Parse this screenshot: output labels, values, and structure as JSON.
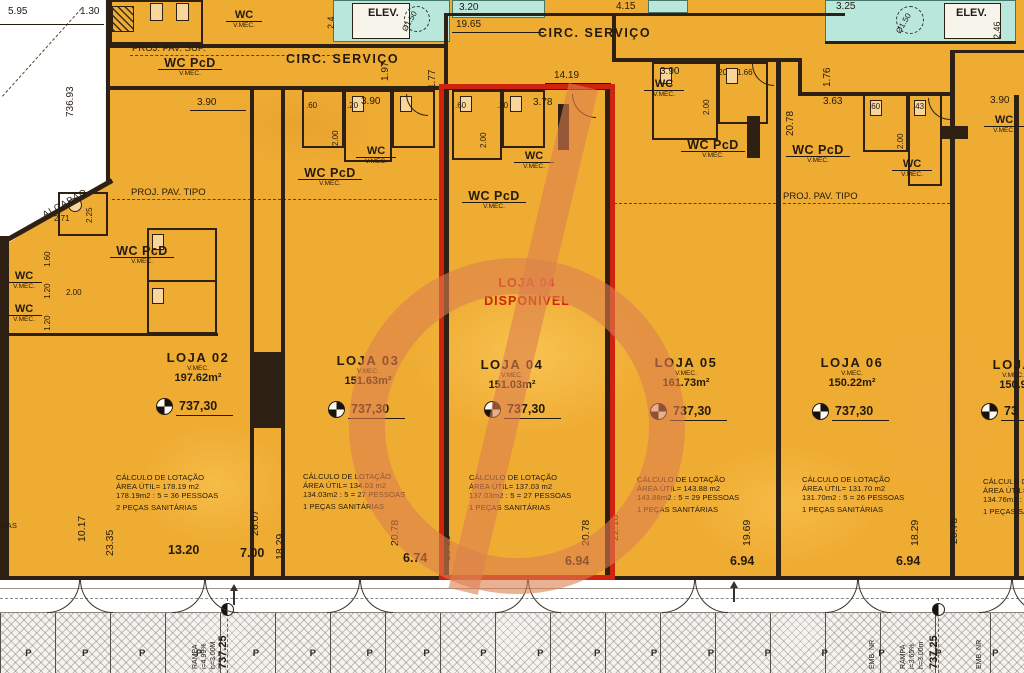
{
  "labels": {
    "circ_servico": "CIRC. SERVIÇO",
    "proj_pav_sup": "PROJ. PAV. SUP.",
    "proj_pav_tipo": "PROJ. PAV. TIPO",
    "elev": "ELEV.",
    "alcapao": "ALÇAPÃO",
    "wc": "WC",
    "wc_pcd": "WC PcD",
    "vmec": "V.MEC."
  },
  "highlight": {
    "unit": "LOJA 04",
    "status": "DISPONÍVEL",
    "border_color": "#cf2310"
  },
  "stores": [
    {
      "name": "LOJA 02",
      "area": "197.62m²",
      "calc": [
        "CÁLCULO DE LOTAÇÃO",
        "ÁREA ÚTIL= 178.19 m2",
        "178.19m2 : 5 = 36 PESSOAS",
        "2 PEÇAS SANITÁRIAS"
      ]
    },
    {
      "name": "LOJA 03",
      "area": "151.63m²",
      "calc": [
        "CÁLCULO DE LOTAÇÃO",
        "ÁREA ÚTIL= 134.03 m2",
        "134.03m2 : 5 = 27 PESSOAS",
        "1 PEÇAS SANITÁRIAS"
      ]
    },
    {
      "name": "LOJA 04",
      "area": "151.03m²",
      "calc": [
        "CÁLCULO DE LOTAÇÃO",
        "ÁREA ÚTIL= 137.03 m2",
        "137.03m2 : 5 = 27 PESSOAS",
        "1 PEÇAS SANITÁRIAS"
      ]
    },
    {
      "name": "LOJA 05",
      "area": "161.73m²",
      "calc": [
        "CÁLCULO DE LOTAÇÃO",
        "ÁREA ÚTIL= 143.88 m2",
        "143.88m2 : 5 = 29 PESSOAS",
        "1 PEÇAS SANITÁRIAS"
      ]
    },
    {
      "name": "LOJA 06",
      "area": "150.22m²",
      "calc": [
        "CÁLCULO DE LOTAÇÃO",
        "ÁREA ÚTIL= 131.70 m2",
        "131.70m2 : 5 = 26 PESSOAS",
        "1 PEÇAS SANITÁRIAS"
      ]
    },
    {
      "name": "LOJA",
      "area": "150.9",
      "level": "73",
      "calc": [
        "CÁLCULO DE LOTAÇÃO",
        "ÁREA ÚTIL= 134.76 m2",
        "134.76m2 : 5 =",
        "1 PEÇAS SANITÁRIAS"
      ]
    }
  ],
  "partial_left_calc": "PESSOAS",
  "levels": {
    "store": "737,30",
    "site": "737.25"
  },
  "dims": {
    "d595": "5.95",
    "d130": "1.30",
    "d73693": "736.93",
    "d225": "2.25",
    "d271": "2.71",
    "d160": "1.60",
    "d120": "1.20",
    "d200": "2.00",
    "d24": "2.4",
    "d320": "3.20",
    "d1965": "19.65",
    "d415": "4.15",
    "d197": "1.97",
    "d177": "1.77",
    "d1419": "14.19",
    "d325": "3.25",
    "d246": "2.46",
    "d176": "1.76",
    "d2078": "20.78",
    "d363": "3.63",
    "d390": "3.90",
    "d378": "3.78",
    "d60": ".60",
    "d20": ".20",
    "d43": ".43",
    "d166": "1.66",
    "d1017": "10.17",
    "d2335": "23.35",
    "d2607": "26.07",
    "d1829": "18.29",
    "d2218": "22.18",
    "d1969": "19.69",
    "d1320": "13.20",
    "d700": "7.00",
    "d674": "6.74",
    "d694": "6.94",
    "diam150": "Ø1.50"
  },
  "site": {
    "rampa": "RAMPA",
    "slope_left": "i=4.99%",
    "height_left": "h=3.00M",
    "slope_right": "i=3.65%",
    "height_right": "h=3.00m",
    "emb_nr": "EMB. NR",
    "parking_p": "P"
  },
  "colors": {
    "plan": "#efac33",
    "wall": "#2e2114",
    "cyan": "#b9e7dc",
    "red": "#cf2310",
    "watermark": "#dc7e4e"
  }
}
